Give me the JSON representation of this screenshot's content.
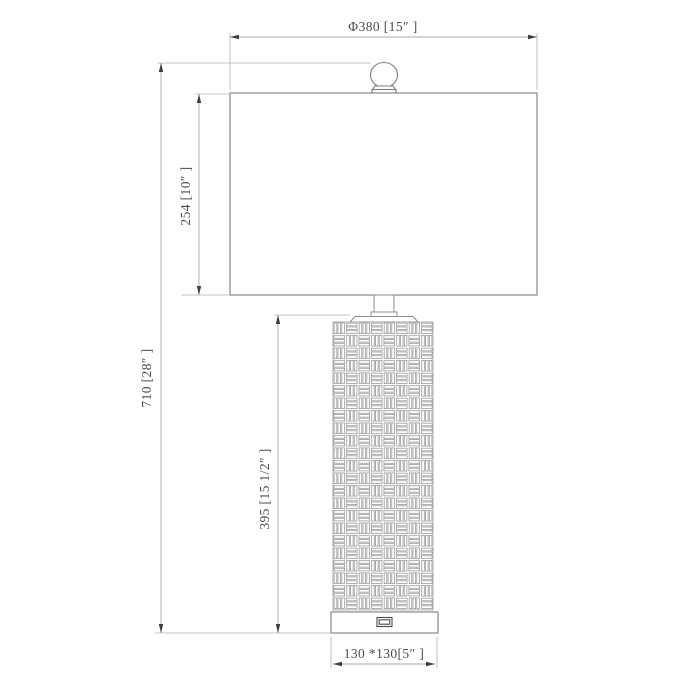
{
  "title": "Table lamp dimension drawing",
  "colors": {
    "background": "#ffffff",
    "lamp_outline": "#7f7f7f",
    "weave_pattern_line": "#9b9b9b",
    "dimension_line": "#a9a9a9",
    "arrow": "#3f3f3f",
    "text": "#4c4c4c"
  },
  "dimensions": {
    "shade_diameter": "Φ380 [15″ ]",
    "overall_height": "710 [28″ ]",
    "shade_height": "254 [10″ ]",
    "body_height": "395 [15 1/2″ ]",
    "base_size": "130 *130[5″ ]"
  },
  "parts": {
    "finial": "finial-ball",
    "shade": "lamp-shade",
    "neck": "neck",
    "body": "basket-weave-body",
    "base": "base",
    "usb": "usb-port"
  }
}
